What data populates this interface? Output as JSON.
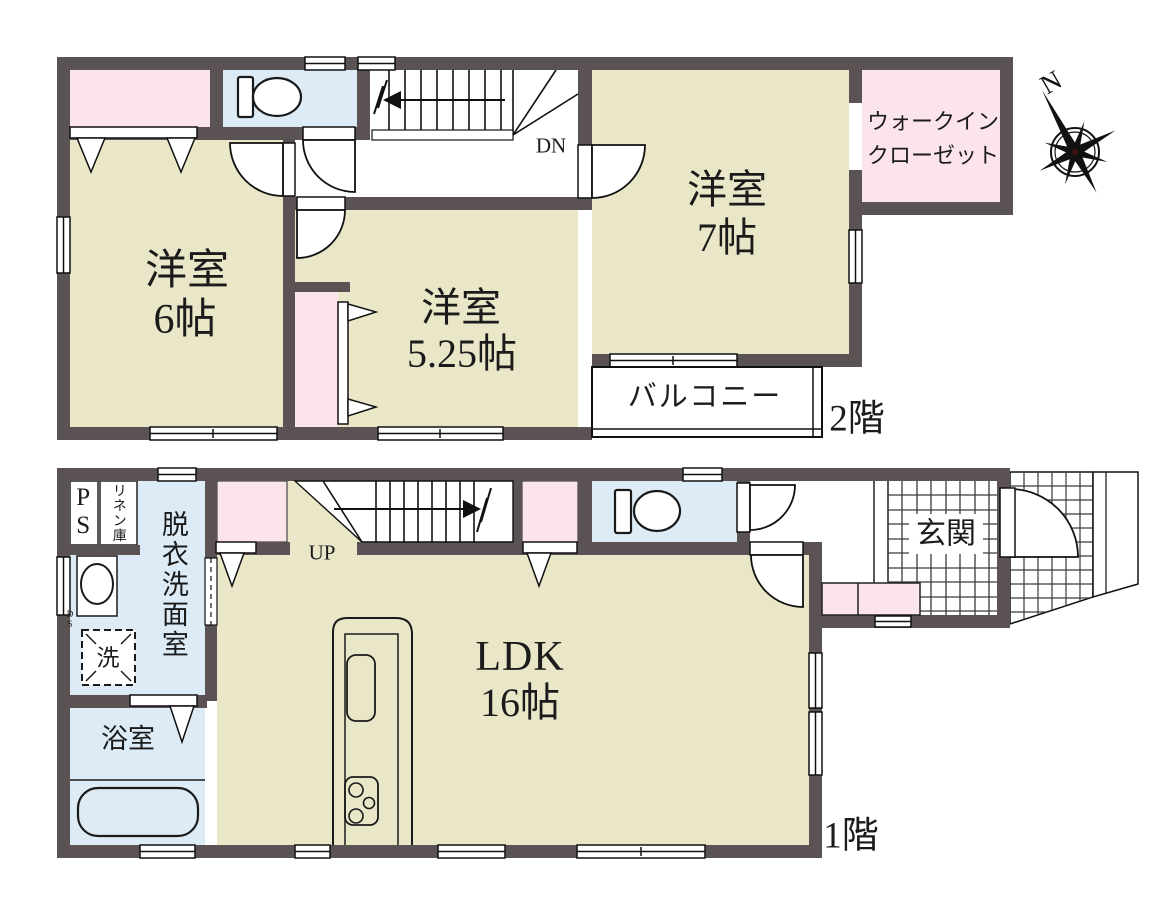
{
  "compass": {
    "north": "N"
  },
  "floor2": {
    "label": "2階",
    "stairs": "DN",
    "room_west6": {
      "name": "洋室",
      "size": "6帖"
    },
    "room_west525": {
      "name": "洋室",
      "size": "5.25帖"
    },
    "room_west7": {
      "name": "洋室",
      "size": "7帖"
    },
    "wic": {
      "line1": "ウォークイン",
      "line2": "クローゼット"
    },
    "balcony": "バルコニー"
  },
  "floor1": {
    "label": "1階",
    "stairs": "UP",
    "ldk": {
      "name": "LDK",
      "size": "16帖"
    },
    "bath": "浴室",
    "washroom": "脱衣洗面室",
    "entrance": "玄関",
    "ps": "PS",
    "linen": "リネン庫",
    "laundry": "洗",
    "ds": "DS"
  },
  "colors": {
    "wall": "#5b5254",
    "room": "#eae6c8",
    "water": "#dcebf6",
    "closet": "#fce5ea"
  }
}
